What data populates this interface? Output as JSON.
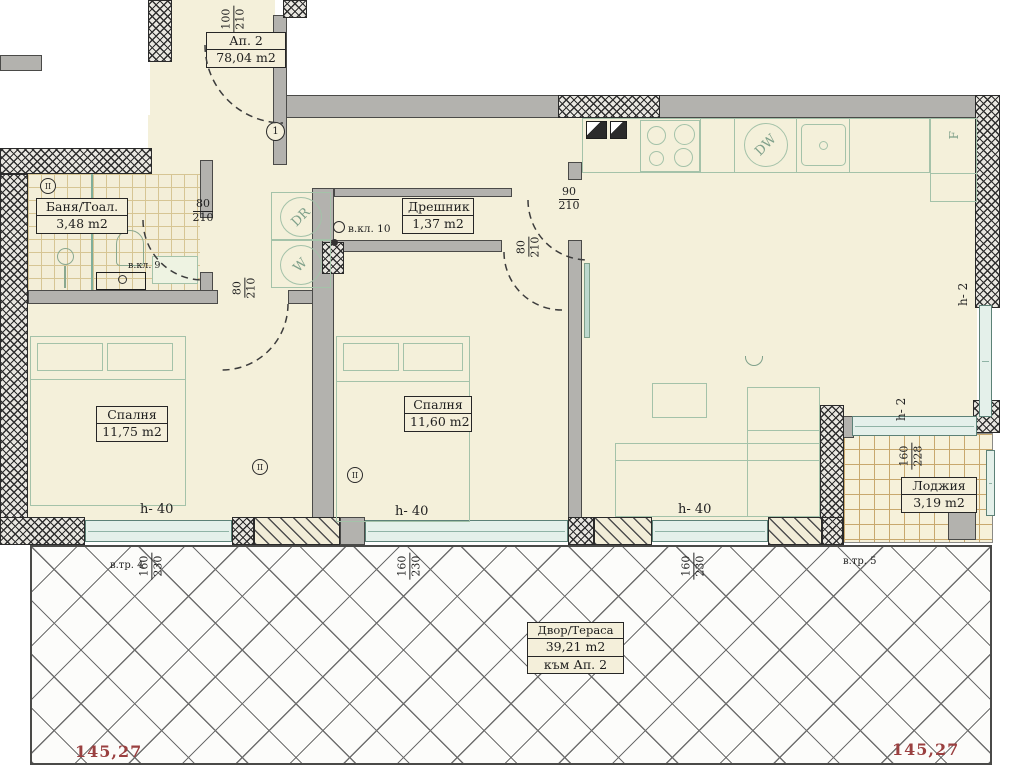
{
  "plan_title": {
    "name": "Ап. 2",
    "area": "78,04 m2"
  },
  "rooms": {
    "bath": {
      "name": "Баня/Тоал.",
      "area": "3,48 m2"
    },
    "closet": {
      "name": "Дрешник",
      "area": "1,37 m2"
    },
    "bedroom1": {
      "name": "Спалня",
      "area": "11,75 m2"
    },
    "bedroom2": {
      "name": "Спалня",
      "area": "11,60 m2"
    },
    "loggia": {
      "name": "Лоджия",
      "area": "3,19 m2"
    },
    "terrace": {
      "name": "Двор/Тераса",
      "area": "39,21 m2",
      "note": "към Ап. 2"
    }
  },
  "dims": {
    "entry_door": {
      "w": "100",
      "h": "210"
    },
    "bath_door": {
      "w": "80",
      "h": "210"
    },
    "bedroom1_door": {
      "w": "80",
      "h": "210"
    },
    "bedroom2_door": {
      "w": "80",
      "h": "210"
    },
    "kitchen_door": {
      "w": "90",
      "h": "210"
    },
    "loggia_window": {
      "w": "160",
      "h": "228"
    },
    "window_left": {
      "w": "160",
      "h": "230"
    },
    "window_mid": {
      "w": "160",
      "h": "230"
    },
    "window_right": {
      "w": "160",
      "h": "230"
    }
  },
  "annotations": {
    "vkl9": "в.кл. 9",
    "vkl10": "в.кл. 10",
    "vtr4": "в.тр. 4",
    "vtr5": "в.тр. 5",
    "h40": "h- 40",
    "h2": "h- 2",
    "level_left": "145,27",
    "level_right": "145,27",
    "marker_entry": "1",
    "marker_wall": "II"
  },
  "appliances": {
    "dryer": "DR",
    "washer": "W",
    "dishwasher": "DW",
    "fridge": "F"
  },
  "colors": {
    "floor": "#f4f0da",
    "wall": "#b3b2ae",
    "furniture_line": "#a4c2a9",
    "level_text": "#9a4040"
  }
}
